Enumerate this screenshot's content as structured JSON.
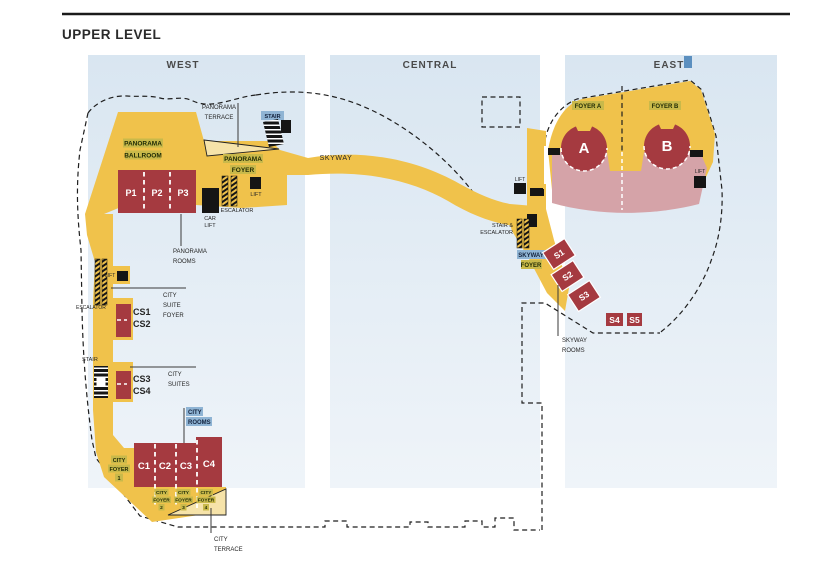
{
  "title": "UPPER LEVEL",
  "sections": {
    "west": "WEST",
    "central": "CENTRAL",
    "east": "EAST"
  },
  "west": {
    "panorama_terrace": [
      "PANORAMA",
      "TERRACE"
    ],
    "panorama_ballroom": [
      "PANORAMA",
      "BALLROOM"
    ],
    "panorama_foyer": [
      "PANORAMA",
      "FOYER"
    ],
    "stair_top_label": "STAIR",
    "foyer_lift_label": "LIFT",
    "foyer_escalator_label": "ESCALATOR",
    "car_lift_label": [
      "CAR",
      "LIFT"
    ],
    "panorama_room_labels": [
      "P1",
      "P2",
      "P3"
    ],
    "panorama_rooms_caption": [
      "PANORAMA",
      "ROOMS"
    ],
    "corridor_lift_label": "LIFT",
    "corridor_escalator_label": "ESCALATOR",
    "city_suite_foyer_caption": [
      "CITY",
      "SUITE",
      "FOYER"
    ],
    "city_suite_labels_upper": [
      "CS1",
      "CS2"
    ],
    "stair_lower_label": "STAIR",
    "city_suite_labels_lower": [
      "CS3",
      "CS4"
    ],
    "city_suites_caption": [
      "CITY",
      "SUITES"
    ],
    "city_rooms_caption": [
      "CITY",
      "ROOMS"
    ],
    "city_foyer_1": [
      "CITY",
      "FOYER",
      "1"
    ],
    "city_room_labels": [
      "C1",
      "C2",
      "C3",
      "C4"
    ],
    "city_foyer_2": [
      "CITY",
      "FOYER",
      "2"
    ],
    "city_foyer_3": [
      "CITY",
      "FOYER",
      "3"
    ],
    "city_foyer_4": [
      "CITY",
      "FOYER",
      "4"
    ],
    "city_terrace_caption": [
      "CITY",
      "TERRACE"
    ]
  },
  "central": {
    "skyway_label": "SKYWAY",
    "lift_label": "LIFT",
    "stair_escalator_caption": [
      "STAIR &",
      "ESCALATOR"
    ],
    "skyway_foyer_caption": [
      "SKYWAY",
      "FOYER"
    ],
    "skyway_room_labels": [
      "S1",
      "S2",
      "S3",
      "S4",
      "S5"
    ],
    "skyway_rooms_caption": [
      "SKYWAY",
      "ROOMS"
    ]
  },
  "east": {
    "foyer_a_label": "FOYER A",
    "foyer_b_label": "FOYER B",
    "hall_a_label": "A",
    "hall_b_label": "B",
    "lift_label": "LIFT"
  },
  "palette": {
    "circulation_yellow": "#F0C24B",
    "room_red": "#A53A40",
    "seating_pink": "#D5A3A8",
    "level_band_blue": "#DCE8F2",
    "label_highlight_olive": "#C9B94A",
    "label_highlight_blue": "#8FB4D4",
    "terrace_cream": "#F6E3A9"
  }
}
